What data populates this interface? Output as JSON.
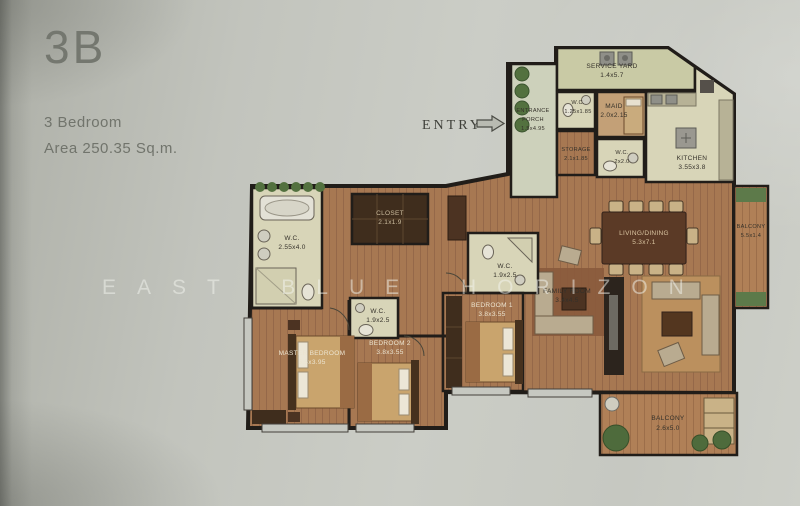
{
  "header": {
    "unit_code": "3B",
    "unit_type": "3 Bedroom",
    "area_label": "Area 250.35 Sq.m."
  },
  "entry": {
    "label": "ENTRY"
  },
  "watermark": {
    "text": "EAST BLUE HORIZON"
  },
  "rooms": {
    "service_yard": {
      "name": "SERVICE YARD",
      "dims": "1.4x5.7"
    },
    "entrance_porch": {
      "line1": "ENTRANCE",
      "line2": "PORCH",
      "dims": "1.5x4.95"
    },
    "wc_entry": {
      "name": "W.C.",
      "dims": "1.25x1.85"
    },
    "maid": {
      "name": "MAID",
      "dims": "2.0x2.15"
    },
    "storage": {
      "name": "STORAGE",
      "dims": "2.1x1.85"
    },
    "wc_kitchen": {
      "name": "W.C.",
      "dims": "2x2.0"
    },
    "kitchen": {
      "name": "KITCHEN",
      "dims": "3.55x3.8"
    },
    "balcony_east": {
      "name": "BALCONY",
      "dims": "5.5x1.4"
    },
    "living_dining": {
      "name": "LIVING/DINING",
      "dims": "5.3x7.1"
    },
    "family_room": {
      "name": "FAMILY ROOM",
      "dims": "3.4x4.5"
    },
    "balcony_south": {
      "name": "BALCONY",
      "dims": "2.6x5.0"
    },
    "wc_master": {
      "name": "W.C.",
      "dims": "2.55x4.0"
    },
    "closet": {
      "name": "CLOSET",
      "dims": "2.1x1.9"
    },
    "wc_bedroom1": {
      "name": "W.C.",
      "dims": "1.9x2.5"
    },
    "wc_bedroom2": {
      "name": "W.C.",
      "dims": "1.9x2.5"
    },
    "master_bedroom": {
      "name": "MASTER BEDROOM",
      "dims": "5.5x3.95"
    },
    "bedroom1": {
      "name": "BEDROOM 1",
      "dims": "3.8x3.55"
    },
    "bedroom2": {
      "name": "BEDROOM 2",
      "dims": "3.8x3.55"
    }
  },
  "colors": {
    "page_bg": "#c6c8c1",
    "wall": "#211d19",
    "wood_floor": "#a77852",
    "tile_cream": "#d8d5b8",
    "service_olive": "#c9caa5",
    "porch_green": "#cdd1bb",
    "plant_green": "#53713f",
    "rug_brown": "#8a5a3c",
    "furniture_tan": "#c9a46d",
    "dark_wood": "#47301f",
    "label_dark": "#35312a",
    "label_light": "#ece4d0",
    "title_gray": "#74776f",
    "watermark": "rgba(243,245,240,0.5)"
  }
}
